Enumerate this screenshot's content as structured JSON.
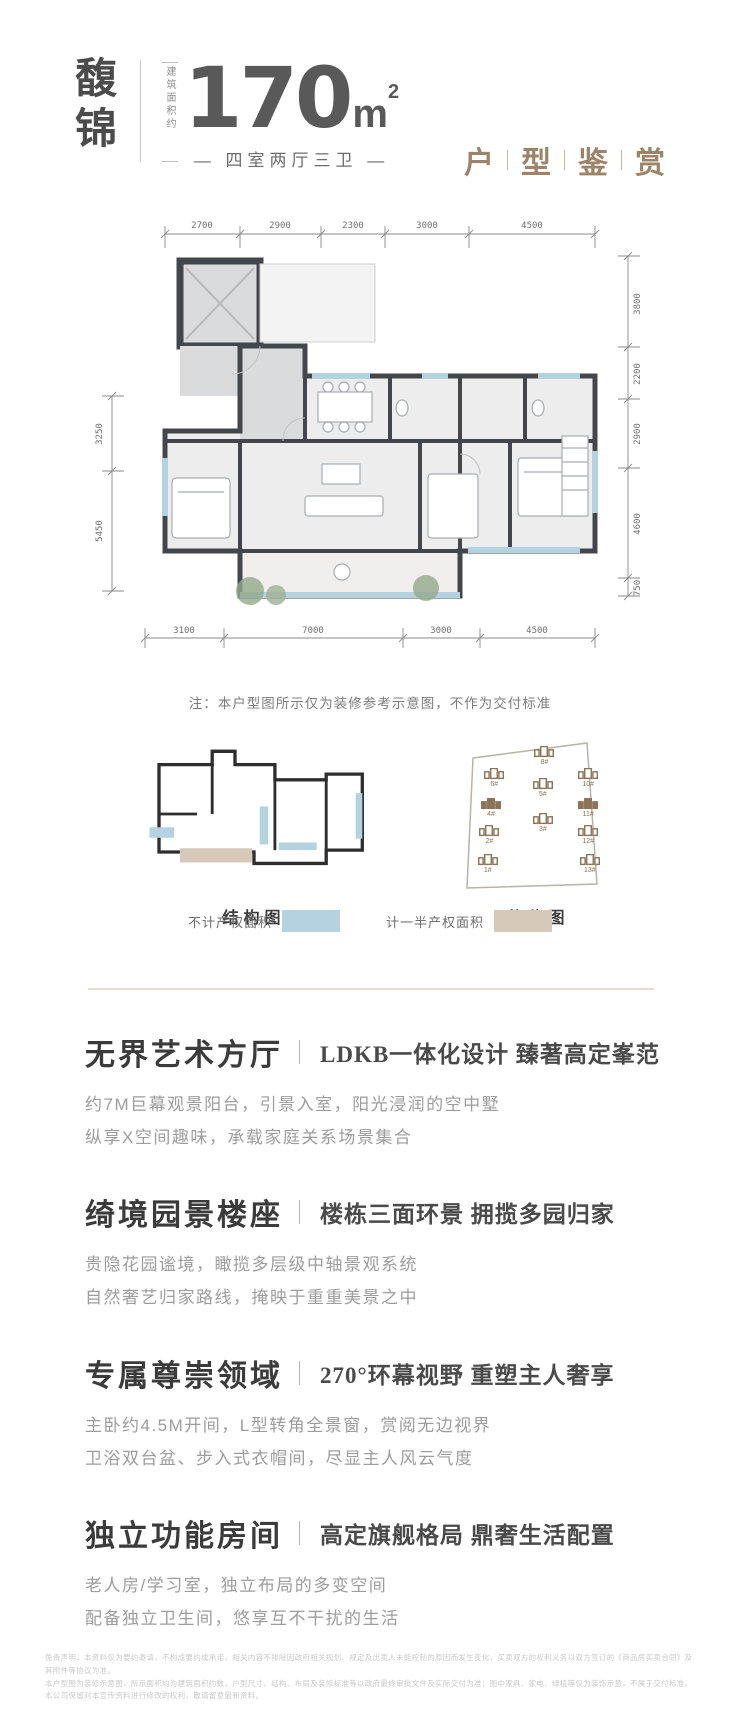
{
  "header": {
    "name_chars": [
      "馥",
      "锦"
    ],
    "area_note": "建筑面积约",
    "area_value": "170",
    "area_unit": "m",
    "area_exp": "2",
    "layout": "— 四室两厅三卫 —",
    "title_chars": [
      "户",
      "型",
      "鉴",
      "赏"
    ],
    "accent_color": "#9d8468"
  },
  "floorplan": {
    "dims_top": [
      "2700",
      "2900",
      "2300",
      "3000",
      "4500"
    ],
    "dims_bottom": [
      "3100",
      "7000",
      "3000",
      "4500"
    ],
    "dims_left": [
      "3250",
      "5450"
    ],
    "dims_right": [
      "3800",
      "2200",
      "2900",
      "4600",
      "750"
    ],
    "note": "注：本户型图所示仅为装修参考示意图，不作为交付标准",
    "wall_color": "#43474b",
    "window_color": "#b5d2e0",
    "public_fill": "#dadbdc",
    "room_fill": "#ecedec"
  },
  "diagrams": {
    "structure": {
      "label": "结构图"
    },
    "location": {
      "label": "落位图",
      "buildings": [
        {
          "id": "8#",
          "x": 54,
          "y": 12,
          "filled": false
        },
        {
          "id": "6#",
          "x": 23,
          "y": 26,
          "filled": false
        },
        {
          "id": "10#",
          "x": 81,
          "y": 26,
          "filled": false
        },
        {
          "id": "5#",
          "x": 53,
          "y": 33,
          "filled": false
        },
        {
          "id": "4#",
          "x": 21,
          "y": 46,
          "filled": true
        },
        {
          "id": "11#",
          "x": 81,
          "y": 46,
          "filled": true
        },
        {
          "id": "3#",
          "x": 53,
          "y": 56,
          "filled": false
        },
        {
          "id": "2#",
          "x": 20,
          "y": 64,
          "filled": false
        },
        {
          "id": "12#",
          "x": 81,
          "y": 64,
          "filled": false
        },
        {
          "id": "1#",
          "x": 19,
          "y": 83,
          "filled": false
        },
        {
          "id": "13#",
          "x": 82,
          "y": 83,
          "filled": false
        }
      ]
    }
  },
  "legend": {
    "items": [
      {
        "label": "不计产权面积",
        "color": "#b5d2e0"
      },
      {
        "label": "计一半产权面积",
        "color": "#d7c9ba"
      }
    ]
  },
  "sections": [
    {
      "title": "无界艺术方厅",
      "subtitle": "LDKB一体化设计 臻著高定峯范",
      "line1": "约7M巨幕观景阳台，引景入室，阳光浸润的空中墅",
      "line2": "纵享X空间趣味，承载家庭关系场景集合"
    },
    {
      "title": "绮境园景楼座",
      "subtitle": "楼栋三面环景 拥揽多园归家",
      "line1": "贵隐花园谧境，瞰揽多层级中轴景观系统",
      "line2": "自然奢艺归家路线，掩映于重重美景之中"
    },
    {
      "title": "专属尊崇领域",
      "subtitle": "270°环幕视野 重塑主人奢享",
      "line1": "主卧约4.5M开间，L型转角全景窗，赏阅无边视界",
      "line2": "卫浴双台盆、步入式衣帽间，尽显主人风云气度"
    },
    {
      "title": "独立功能房间",
      "subtitle": "高定旗舰格局 鼎奢生活配置",
      "line1": "老人房/学习室，独立布局的多变空间",
      "line2": "配备独立卫生间，悠享互不干扰的生活"
    }
  ],
  "disclaimer": {
    "lines": [
      "免责声明：本资料仅为要约邀请，不构成要约或承诺，相关内容不排除因政府相关规划、规定及出卖人未能控制的原因而发生变化，买卖双方的权利义务以双方签订的《商品房买卖合同》及其附件等协议为准。",
      "本户型图为装修示意图，所示面积均为建筑面积约数，户型尺寸、结构、布局及装修标准等以政府最终审批文件及实际交付为准；图中家具、家电、绿植等仅为装饰示意，不属于交付标准。",
      "本公司保留对本宣传资料进行修改的权利，敬请留意最新资料。"
    ]
  }
}
